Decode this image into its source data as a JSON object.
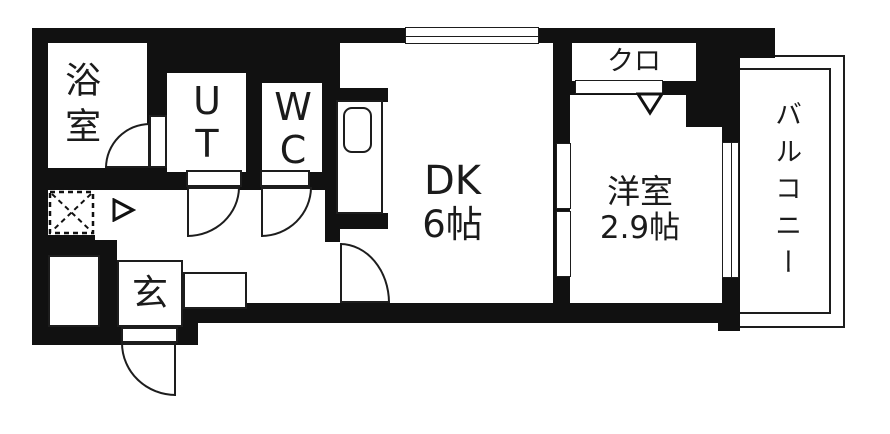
{
  "floorplan": {
    "rooms": {
      "bathroom": {
        "label": "浴室"
      },
      "utility": {
        "line1": "U",
        "line2": "T"
      },
      "toilet": {
        "line1": "W",
        "line2": "C"
      },
      "dining_kitchen": {
        "name": "DK",
        "size": "6帖"
      },
      "western_room": {
        "name": "洋室",
        "size": "2.9帖"
      },
      "closet": {
        "label": "クロ"
      },
      "entrance": {
        "label": "玄"
      },
      "balcony": {
        "label": "バルコニー"
      }
    },
    "colors": {
      "wall": "#111111",
      "line": "#1d1d1d",
      "floor": "#ffffff"
    }
  }
}
